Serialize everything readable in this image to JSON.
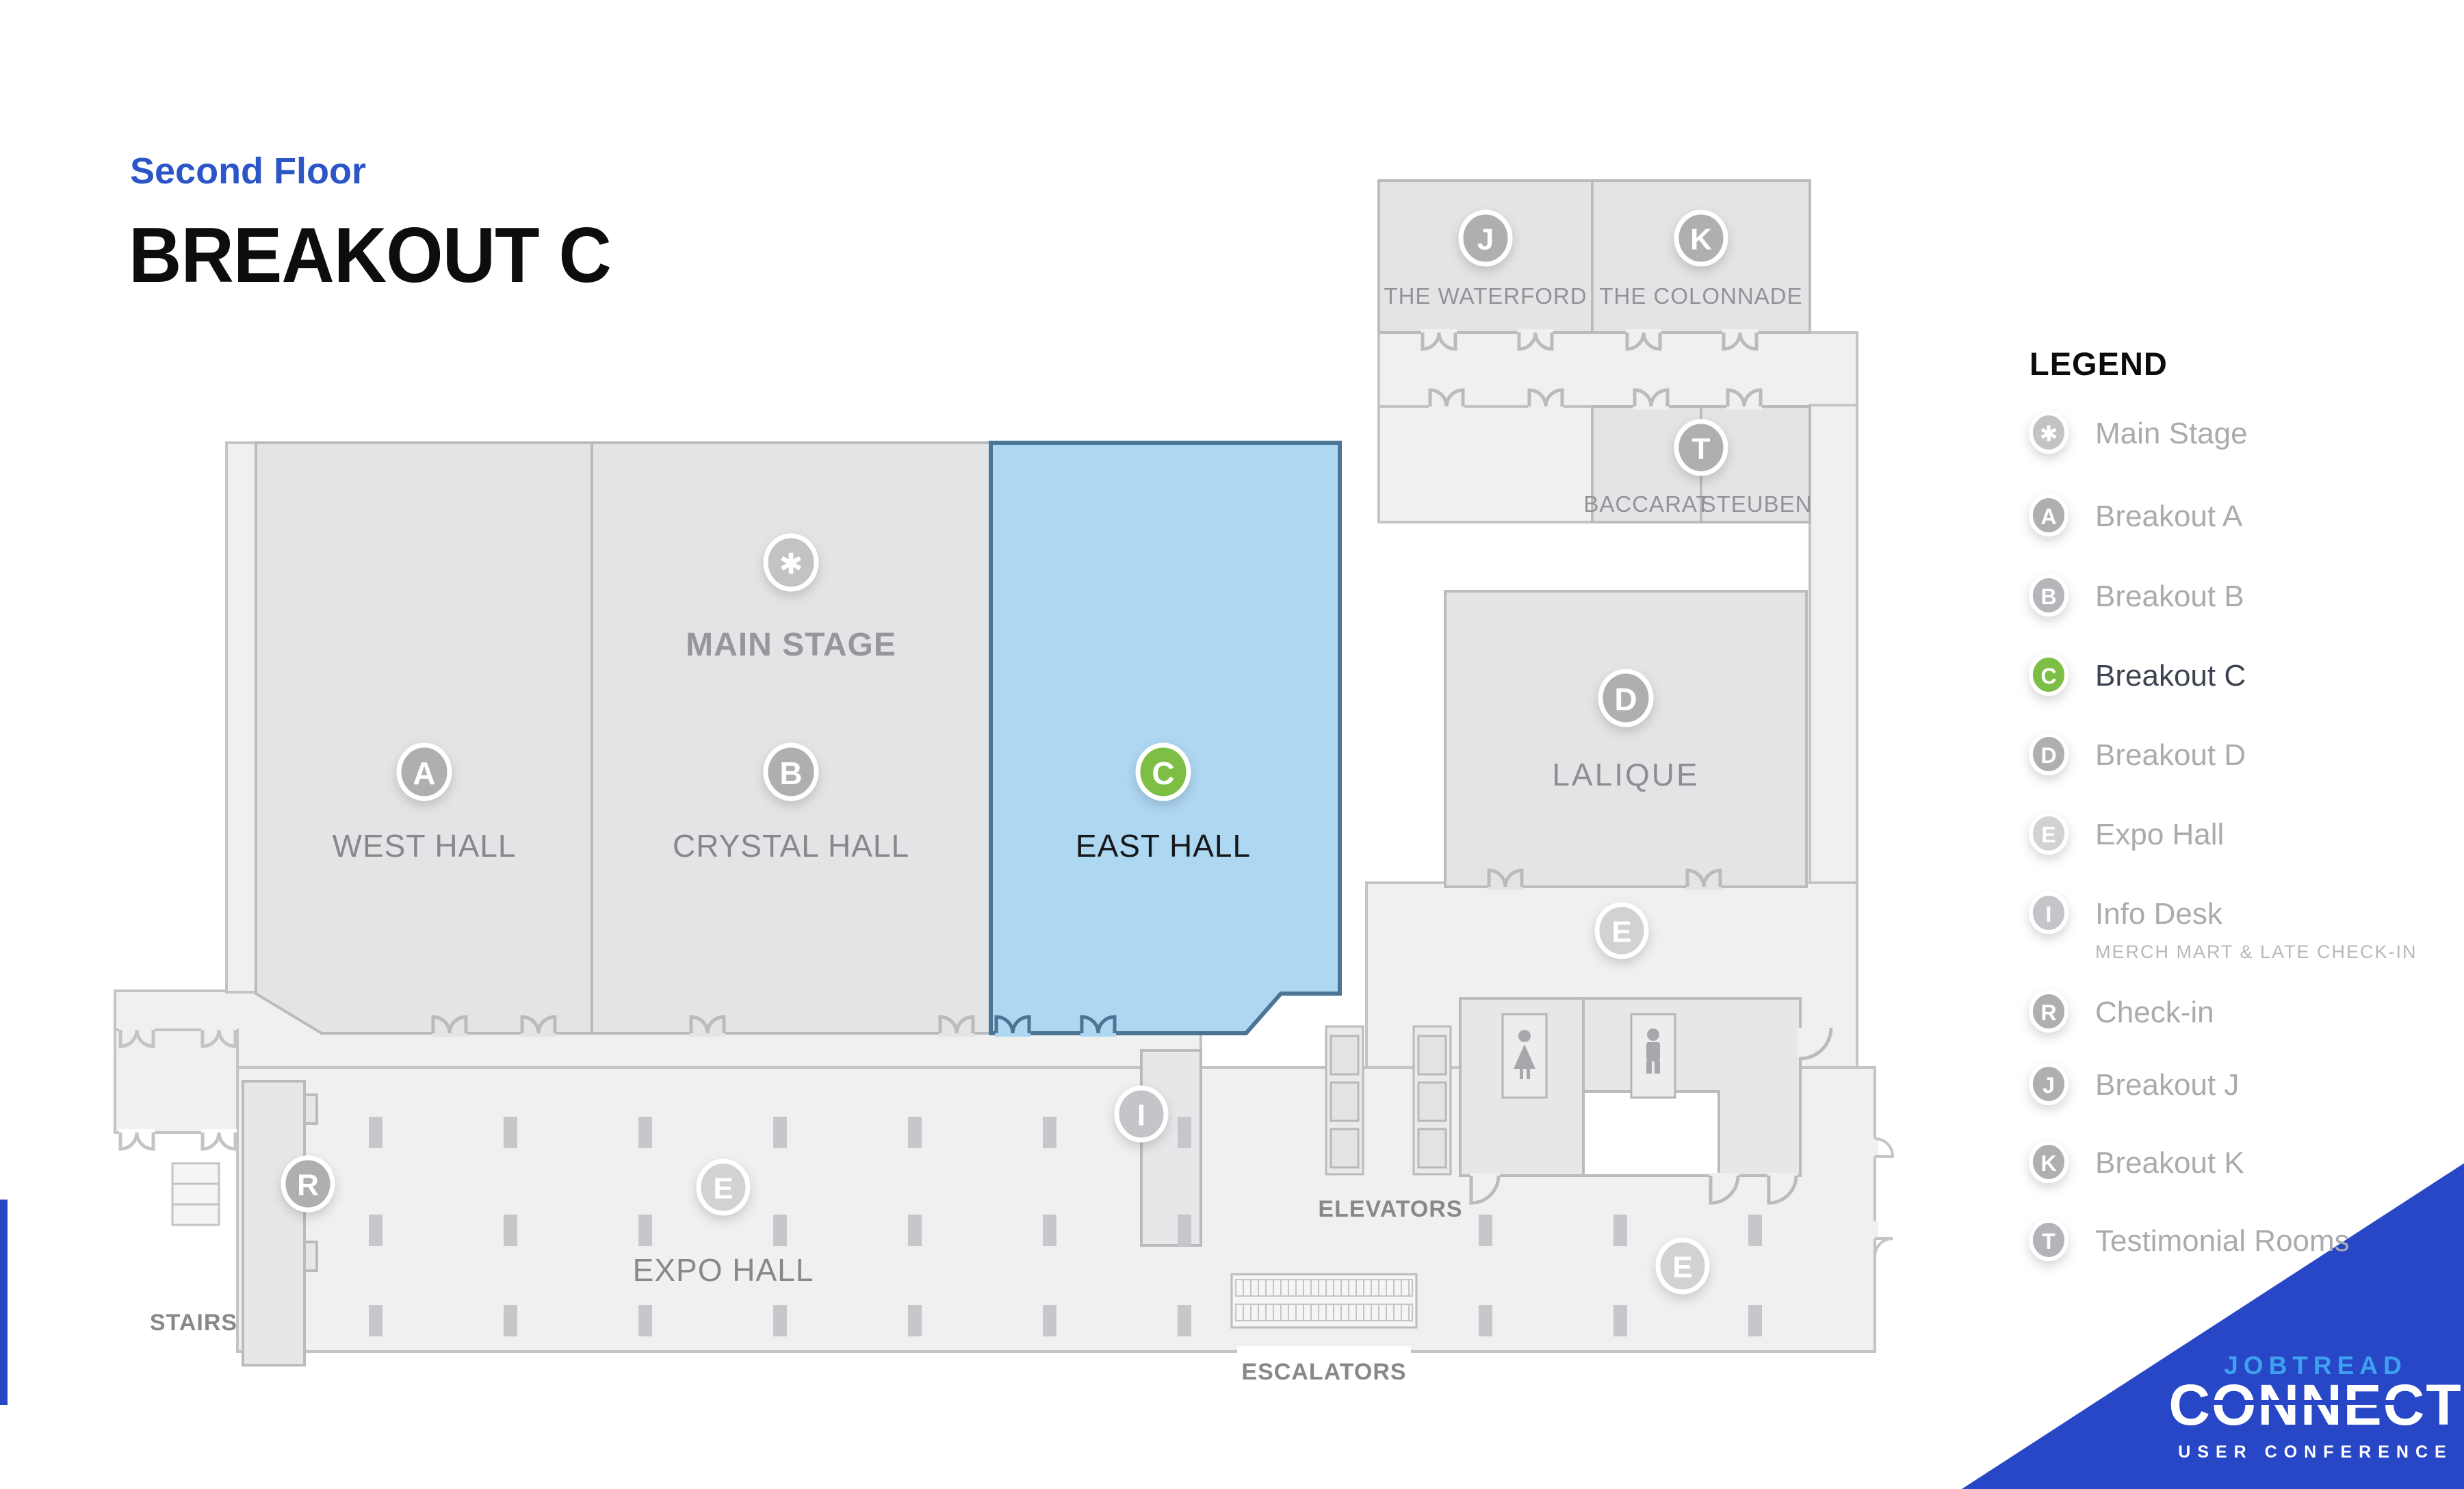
{
  "page": {
    "eyebrow": "Second Floor",
    "title": "BREAKOUT C"
  },
  "colors": {
    "heading_blue": "#2c55c7",
    "banner_blue": "#2847c6",
    "brand_light_blue": "#3da0f0",
    "highlight_fill": "#aed7f2",
    "highlight_stroke": "#4a7595",
    "active_green": "#7dbf45",
    "badge_gray": "#adafb1",
    "badge_light_gray": "#d0d2d4",
    "room_gray": "#e3e4e5",
    "corridor_gray": "#eff0f0",
    "wall_gray": "#b9bbbd"
  },
  "map": {
    "rooms": {
      "west_hall": {
        "badge": "A",
        "label": "WEST HALL"
      },
      "crystal_hall": {
        "badge": "B",
        "label": "CRYSTAL HALL"
      },
      "main_stage": {
        "badge": "✱",
        "label": "MAIN STAGE"
      },
      "east_hall": {
        "badge": "C",
        "label": "EAST HALL"
      },
      "waterford": {
        "badge": "J",
        "label": "THE WATERFORD"
      },
      "colonnade": {
        "badge": "K",
        "label": "THE COLONNADE"
      },
      "testimonial": {
        "badge": "T",
        "rooms": [
          "BACCARAT",
          "STEUBEN"
        ]
      },
      "lalique": {
        "badge": "D",
        "label": "LALIQUE"
      },
      "expo_hall": {
        "badge": "E",
        "label": "EXPO HALL"
      },
      "info_desk": {
        "badge": "I"
      },
      "check_in": {
        "badge": "R"
      }
    },
    "labels": {
      "stairs": "STAIRS",
      "elevators": "ELEVATORS",
      "escalators": "ESCALATORS"
    }
  },
  "legend": {
    "heading": "LEGEND",
    "items": [
      {
        "badge": "✱",
        "label": "Main Stage",
        "badge_color": "#c1c3c5"
      },
      {
        "badge": "A",
        "label": "Breakout A",
        "badge_color": "#adafb1"
      },
      {
        "badge": "B",
        "label": "Breakout B",
        "badge_color": "#b4b6b9"
      },
      {
        "badge": "C",
        "label": "Breakout C",
        "badge_color": "#7dbf45",
        "active": true
      },
      {
        "badge": "D",
        "label": "Breakout D",
        "badge_color": "#adafb1"
      },
      {
        "badge": "E",
        "label": "Expo Hall",
        "badge_color": "#d0d2d4"
      },
      {
        "badge": "I",
        "label": "Info Desk",
        "badge_color": "#c3c5c8",
        "sublabel": "MERCH MART & LATE CHECK-IN"
      },
      {
        "badge": "R",
        "label": "Check-in",
        "badge_color": "#adafb1"
      },
      {
        "badge": "J",
        "label": "Breakout J",
        "badge_color": "#adafb1"
      },
      {
        "badge": "K",
        "label": "Breakout K",
        "badge_color": "#adafb1"
      },
      {
        "badge": "T",
        "label": "Testimonial Rooms",
        "badge_color": "#b2b4b7"
      }
    ]
  },
  "logo": {
    "brand": "JOBTREAD",
    "name": "CONNECT",
    "tagline": "USER CONFERENCE"
  }
}
